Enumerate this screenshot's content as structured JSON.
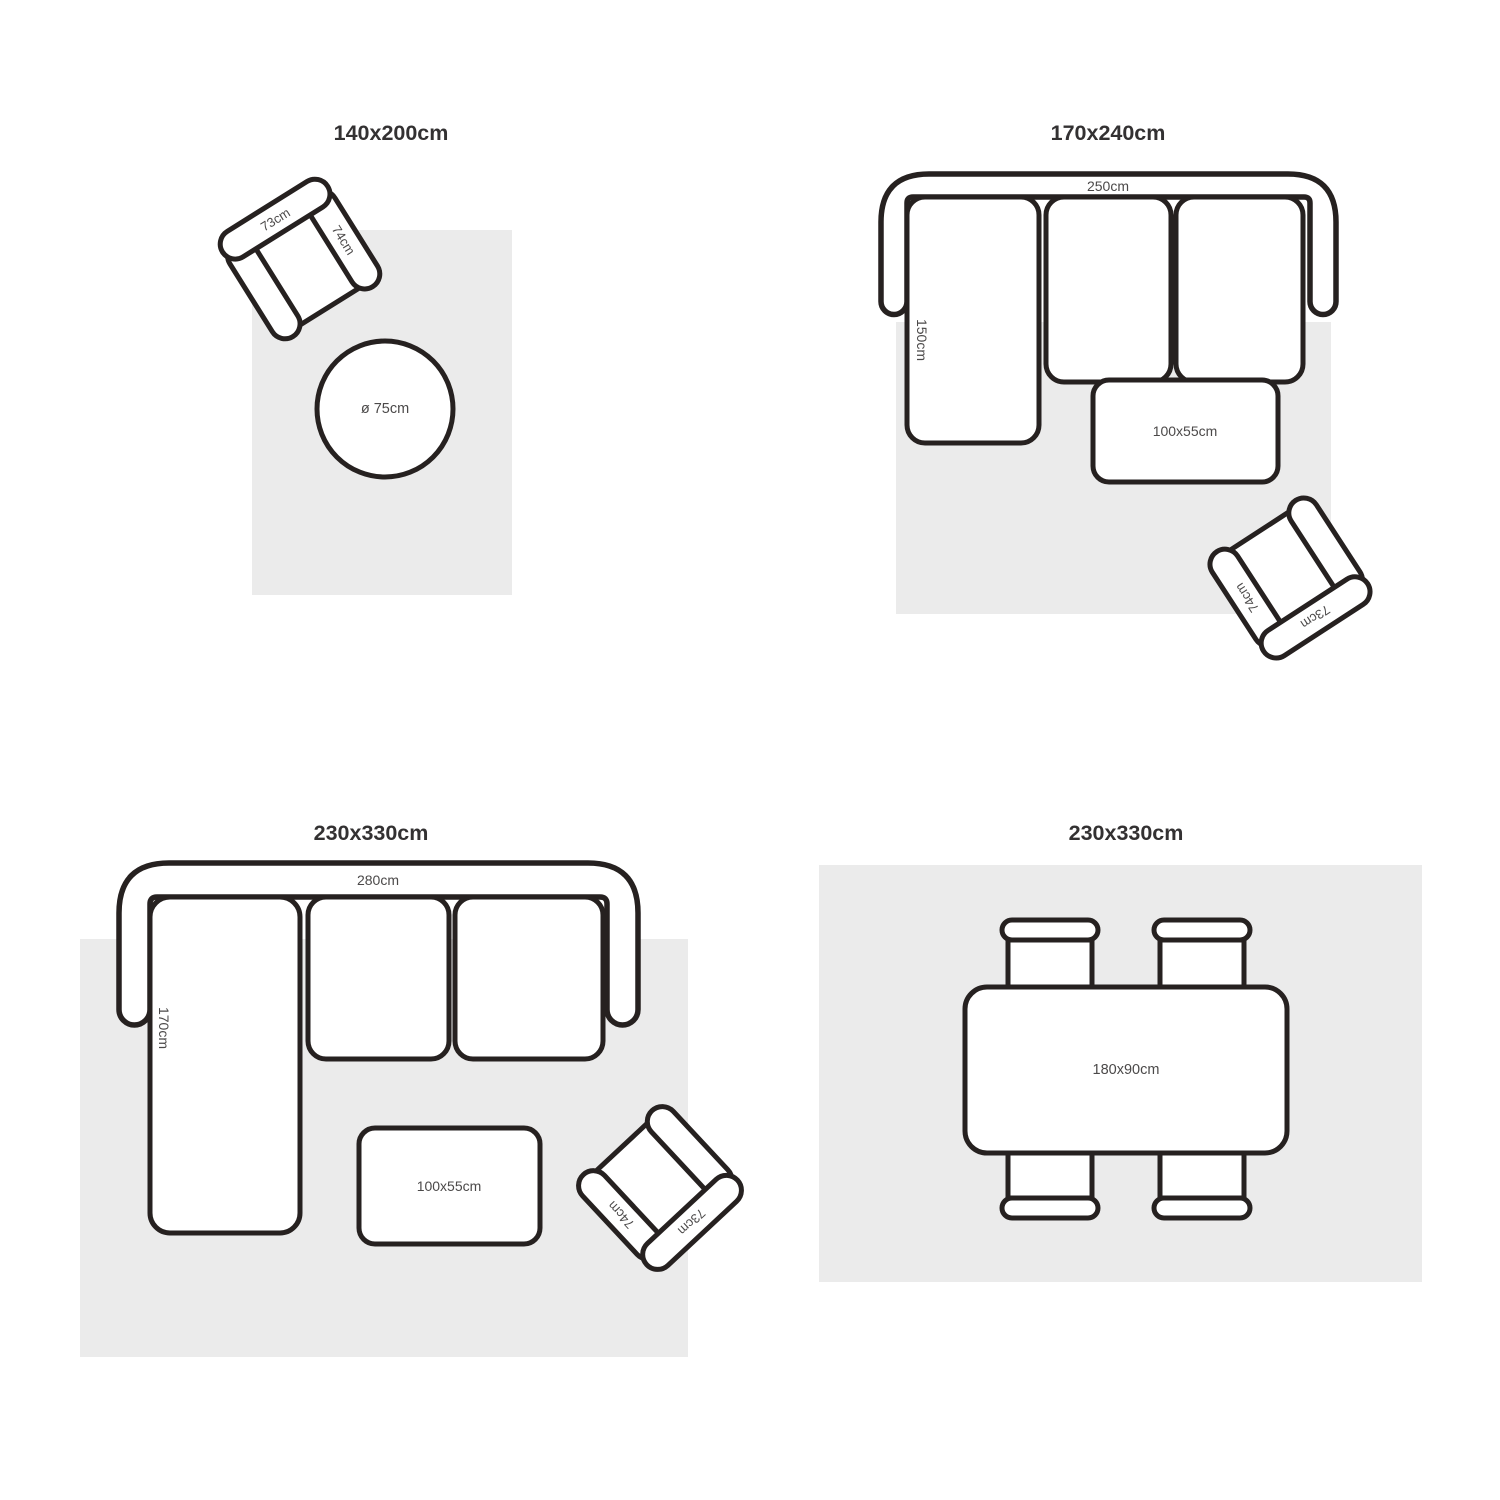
{
  "colors": {
    "background": "#ffffff",
    "outline": "#262120",
    "rug_fill": "#ebebeb",
    "furniture_fill": "#ffffff",
    "label_color": "#4b4949",
    "title_color": "#333132"
  },
  "shared": {
    "armchair_back_label": "73cm",
    "armchair_arm_label": "74cm"
  },
  "quadrants": {
    "top_left": {
      "title": "140x200cm",
      "round_table_label": "ø 75cm"
    },
    "top_right": {
      "title": "170x240cm",
      "sofa_width_label": "250cm",
      "sofa_chaise_label": "150cm",
      "coffee_table_label": "100x55cm"
    },
    "bottom_left": {
      "title": "230x330cm",
      "sofa_width_label": "280cm",
      "sofa_chaise_label": "170cm",
      "coffee_table_label": "100x55cm"
    },
    "bottom_right": {
      "title": "230x330cm",
      "dining_table_label": "180x90cm"
    }
  }
}
